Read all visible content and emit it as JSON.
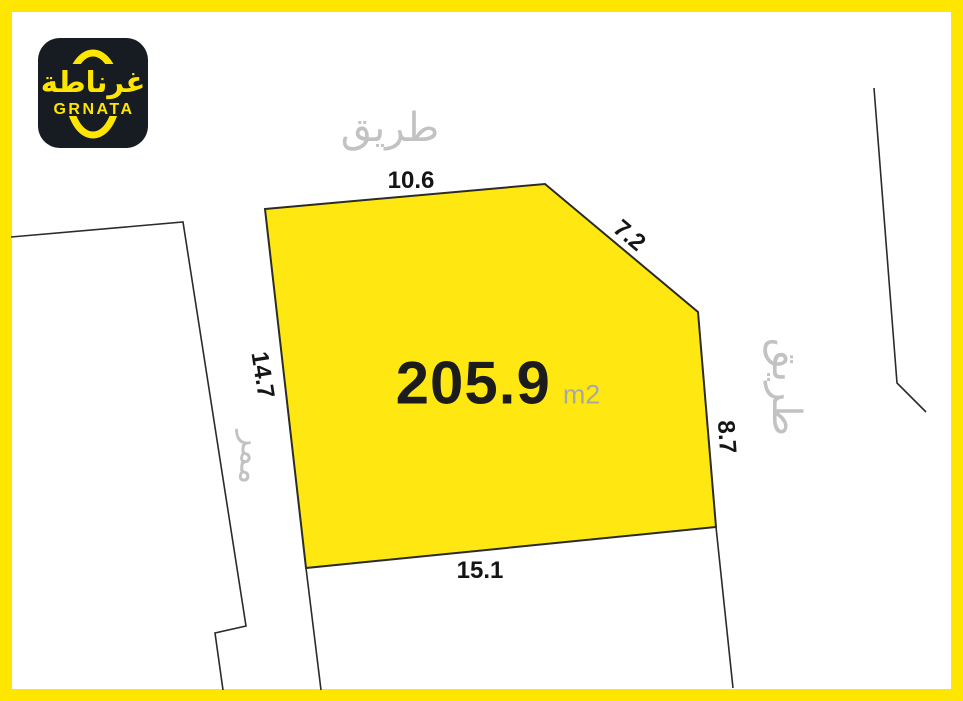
{
  "logo": {
    "arabic": "غرناطة",
    "latin": "GRNATA"
  },
  "roads": {
    "top": "طريق",
    "right": "طريق",
    "passage_left": "ممر"
  },
  "parcel": {
    "area": "205.9",
    "area_unit": "m2",
    "sides": {
      "top": "10.6",
      "top_right_diagonal": "7.2",
      "right": "8.7",
      "bottom": "15.1",
      "left": "14.7"
    }
  },
  "colors": {
    "frame_yellow": "#FFE600",
    "parcel_fill": "#FFE712",
    "line": "#2B2B2B",
    "road_text": "#C2C2C2",
    "measure_text": "#151515",
    "area_text": "#1C1C1C",
    "unit_text": "#A8A8A8",
    "logo_bg": "#171B22",
    "logo_yellow": "#FFE600"
  }
}
